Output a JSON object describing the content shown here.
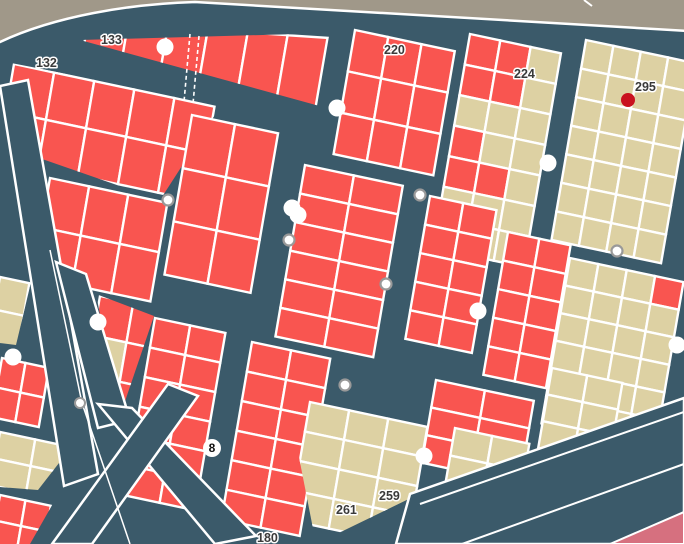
{
  "map": {
    "colors": {
      "street": "#3b5a6a",
      "parcel_red": "#f95550",
      "parcel_tan": "#ddd1a3",
      "outside_gray": "#a09889",
      "pink_zone": "#d6707f",
      "border_white": "#ffffff",
      "selected_dot_red": "#c9111f",
      "node_ring_gray": "#999999",
      "label_text": "#3a3a3a"
    },
    "labels": [
      {
        "text": "133",
        "x": 101,
        "y": 44
      },
      {
        "text": "132",
        "x": 36,
        "y": 67
      },
      {
        "text": "220",
        "x": 384,
        "y": 54
      },
      {
        "text": "224",
        "x": 514,
        "y": 78
      },
      {
        "text": "295",
        "x": 635,
        "y": 91
      },
      {
        "text": "259",
        "x": 379,
        "y": 500
      },
      {
        "text": "261",
        "x": 336,
        "y": 514
      },
      {
        "text": "180",
        "x": 257,
        "y": 542
      }
    ],
    "route_badge": {
      "text": "8",
      "x": 212,
      "y": 448,
      "r": 9
    },
    "selected_dot": {
      "x": 628,
      "y": 100,
      "r": 7
    },
    "poi_markers_white": [
      [
        165,
        47
      ],
      [
        337,
        108
      ],
      [
        292,
        208
      ],
      [
        298,
        215
      ],
      [
        478,
        311
      ],
      [
        98,
        322
      ],
      [
        13,
        357
      ],
      [
        548,
        163
      ],
      [
        424,
        456
      ],
      [
        677,
        345
      ]
    ],
    "node_markers": [
      [
        168,
        200
      ],
      [
        289,
        240
      ],
      [
        420,
        195
      ],
      [
        386,
        284
      ],
      [
        617,
        251
      ],
      [
        345,
        385
      ]
    ],
    "survey_line": {
      "points": [
        [
          50,
          250
        ],
        [
          82,
          403
        ],
        [
          130,
          544
        ]
      ],
      "vertex": [
        80,
        403
      ]
    },
    "basis_default": [
      0.978,
      0.208,
      -0.17,
      0.985
    ],
    "blocks": [
      {
        "id": "b133",
        "anchor": [
          88,
          22
        ],
        "cols": 6,
        "rows": 1,
        "cw": 40,
        "ch": 95,
        "color": "red",
        "basis": [
          0.998,
          0.066,
          -0.17,
          0.985
        ],
        "clip": [
          [
            80,
            40
          ],
          [
            334,
            33
          ],
          [
            334,
            110
          ]
        ]
      },
      {
        "id": "b132",
        "anchor": [
          14,
          64
        ],
        "cols": 5,
        "rows": 2,
        "cw": 41,
        "ch": 48,
        "color": "red",
        "clip": [
          [
            6,
            62
          ],
          [
            222,
            104
          ],
          [
            160,
            200
          ],
          [
            22,
            152
          ]
        ]
      },
      {
        "id": "b-m",
        "anchor": [
          50,
          178
        ],
        "cols": 3,
        "rows": 2,
        "cw": 40,
        "ch": 50,
        "color": "red"
      },
      {
        "id": "b-c1",
        "anchor": [
          192,
          115
        ],
        "cols": 2,
        "rows": 3,
        "cw": 44,
        "ch": 54,
        "color": "red"
      },
      {
        "id": "b220",
        "anchor": [
          355,
          30
        ],
        "cols": 3,
        "rows": 3,
        "cw": 34,
        "ch": 42,
        "color": "red"
      },
      {
        "id": "b224",
        "anchor": [
          470,
          34
        ],
        "cols": 3,
        "rows": 7,
        "cw": 31,
        "ch": 31,
        "color": "tan",
        "overrides": [
          [
            0,
            0,
            "red"
          ],
          [
            1,
            0,
            "red"
          ],
          [
            0,
            1,
            "red"
          ],
          [
            1,
            1,
            "red"
          ],
          [
            0,
            3,
            "red"
          ],
          [
            0,
            4,
            "red"
          ],
          [
            1,
            4,
            "red"
          ]
        ]
      },
      {
        "id": "b295",
        "anchor": [
          586,
          40
        ],
        "cols": 4,
        "rows": 7,
        "cw": 28,
        "ch": 29,
        "color": "tan"
      },
      {
        "id": "b-cm",
        "anchor": [
          305,
          165
        ],
        "cols": 2,
        "rows": 6,
        "cw": 50,
        "ch": 29,
        "color": "red"
      },
      {
        "id": "b-r3",
        "anchor": [
          430,
          196
        ],
        "cols": 2,
        "rows": 5,
        "cw": 34,
        "ch": 29,
        "color": "red"
      },
      {
        "id": "b-r4",
        "anchor": [
          508,
          232
        ],
        "cols": 2,
        "rows": 5,
        "cw": 32,
        "ch": 29,
        "color": "red"
      },
      {
        "id": "b-r2",
        "anchor": [
          570,
          258
        ],
        "cols": 4,
        "rows": 6,
        "cw": 29,
        "ch": 28,
        "color": "tan",
        "overrides": [
          [
            3,
            0,
            "red"
          ]
        ]
      },
      {
        "id": "b-c2",
        "anchor": [
          155,
          318
        ],
        "cols": 2,
        "rows": 6,
        "cw": 36,
        "ch": 30,
        "color": "red"
      },
      {
        "id": "b-c3",
        "anchor": [
          252,
          342
        ],
        "cols": 2,
        "rows": 6,
        "cw": 40,
        "ch": 30,
        "color": "red"
      },
      {
        "id": "b-x1",
        "anchor": [
          436,
          380
        ],
        "cols": 2,
        "rows": 3,
        "cw": 50,
        "ch": 28,
        "color": "red"
      },
      {
        "id": "b-t261",
        "anchor": [
          310,
          402
        ],
        "cols": 3,
        "rows": 4,
        "cw": 40,
        "ch": 30,
        "color": "tan",
        "clip": [
          [
            296,
            396
          ],
          [
            450,
            428
          ],
          [
            452,
            478
          ],
          [
            316,
            544
          ],
          [
            298,
            452
          ]
        ]
      },
      {
        "id": "b-t2",
        "anchor": [
          455,
          428
        ],
        "cols": 2,
        "rows": 3,
        "cw": 38,
        "ch": 28,
        "color": "tan"
      },
      {
        "id": "b-x2",
        "anchor": [
          552,
          368
        ],
        "cols": 2,
        "rows": 3,
        "cw": 36,
        "ch": 27,
        "color": "tan"
      },
      {
        "id": "tri1",
        "anchor": [
          100,
          296
        ],
        "cols": 2,
        "rows": 3,
        "cw": 34,
        "ch": 40,
        "color": "red",
        "overrides": [
          [
            0,
            1,
            "tan"
          ]
        ],
        "clip": [
          [
            96,
            294
          ],
          [
            154,
            316
          ],
          [
            120,
            416
          ]
        ]
      },
      {
        "id": "tanL",
        "anchor": [
          0,
          277
        ],
        "cols": 1,
        "rows": 2,
        "cw": 30,
        "ch": 33,
        "color": "tan",
        "clip": [
          [
            0,
            275
          ],
          [
            32,
            278
          ],
          [
            16,
            345
          ],
          [
            0,
            343
          ]
        ]
      },
      {
        "id": "redL",
        "anchor": [
          2,
          358
        ],
        "cols": 2,
        "rows": 2,
        "cw": 24,
        "ch": 30,
        "color": "red"
      },
      {
        "id": "tanL2",
        "anchor": [
          0,
          432
        ],
        "cols": 2,
        "rows": 2,
        "cw": 36,
        "ch": 27,
        "color": "tan",
        "clip": [
          [
            0,
            430
          ],
          [
            80,
            436
          ],
          [
            38,
            490
          ],
          [
            0,
            487
          ]
        ]
      },
      {
        "id": "redC",
        "anchor": [
          0,
          495
        ],
        "cols": 2,
        "rows": 2,
        "cw": 26,
        "ch": 26,
        "color": "red",
        "clip": [
          [
            0,
            492
          ],
          [
            55,
            500
          ],
          [
            30,
            544
          ],
          [
            0,
            544
          ]
        ]
      }
    ],
    "avenues": [
      [
        [
          0,
          86
        ],
        [
          28,
          80
        ],
        [
          98,
          474
        ],
        [
          64,
          486
        ]
      ],
      [
        [
          56,
          262
        ],
        [
          86,
          274
        ],
        [
          130,
          420
        ],
        [
          98,
          428
        ]
      ],
      [
        [
          98,
          404
        ],
        [
          132,
          408
        ],
        [
          256,
          536
        ],
        [
          215,
          544
        ]
      ],
      [
        [
          168,
          384
        ],
        [
          198,
          396
        ],
        [
          92,
          544
        ],
        [
          52,
          544
        ]
      ],
      [
        [
          396,
          544
        ],
        [
          410,
          494
        ],
        [
          684,
          398
        ],
        [
          684,
          544
        ]
      ]
    ],
    "lane_lines": [
      [
        [
          420,
          504
        ],
        [
          684,
          412
        ]
      ],
      [
        [
          462,
          544
        ],
        [
          684,
          464
        ]
      ]
    ],
    "pink_zone": [
      [
        610,
        544
      ],
      [
        684,
        512
      ],
      [
        684,
        544
      ]
    ],
    "gray_outside": {
      "path": "M -5 -5 L 689 -5 L 689 31 L 195 2 C 130 4 55 16 0 42 L -5 44 Z",
      "notch": [
        [
          584,
          0
        ],
        [
          592,
          6
        ]
      ]
    },
    "dashed_parcel_lines": [
      [
        [
          190,
          34
        ],
        [
          184,
          102
        ]
      ],
      [
        [
          199,
          36
        ],
        [
          193,
          104
        ]
      ]
    ]
  }
}
